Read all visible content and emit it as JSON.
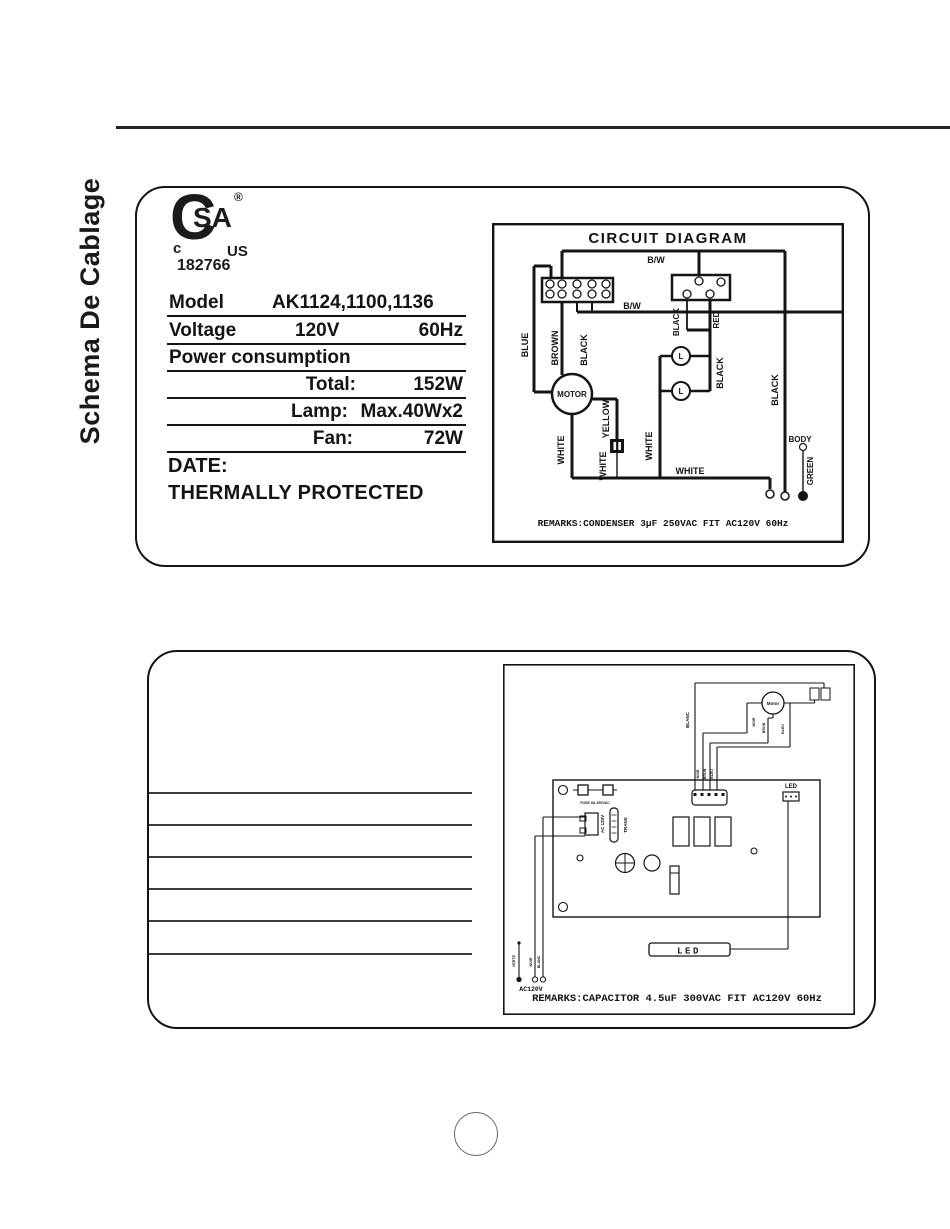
{
  "page": {
    "side_title": "Schema De Cablage"
  },
  "csa": {
    "mark_c": "C",
    "mark_sa": "SA",
    "reg": "®",
    "small_c": "c",
    "small_us": "US",
    "number": "182766"
  },
  "spec": {
    "rows": [
      {
        "c1": "Model",
        "c2": "AK1124,1100,1136",
        "c3": ""
      },
      {
        "c1": "Voltage",
        "c2": "120V",
        "c3": "60Hz"
      },
      {
        "c1": "Power consumption",
        "c2": "",
        "c3": ""
      },
      {
        "c1": "",
        "c2": "Total:",
        "c3": "152W"
      },
      {
        "c1": "",
        "c2": "Lamp:",
        "c3": "Max.40Wx2"
      },
      {
        "c1": "",
        "c2": "Fan:",
        "c3": "72W"
      }
    ],
    "date": "DATE:",
    "thermal": "THERMALLY PROTECTED"
  },
  "circuit1": {
    "title": "CIRCUIT DIAGRAM",
    "bw_top": "B/W",
    "bw_mid": "B/W",
    "blue": "BLUE",
    "brown": "BROWN",
    "black_left": "BLACK",
    "black_conn": "BLACK",
    "red": "RED",
    "black_lamp": "BLACK",
    "black_right": "BLACK",
    "white_motor": "WHITE",
    "white_cap": "WHITE",
    "white_lamp": "WHITE",
    "white_bottom": "WHITE",
    "yellow": "YELLOW",
    "motor": "MOTOR",
    "lamp1": "L",
    "lamp2": "L",
    "body": "BODY",
    "green": "GREEN",
    "remarks": "REMARKS:CONDENSER 3µF  250VAC FIT AC120V 60Hz"
  },
  "circuit2": {
    "motor": "Motor",
    "blanc": "BLANC",
    "noir_motor": "NOIR",
    "brun_motor": "BRUN",
    "bleu_motor": "BLEU",
    "noir_conn": "NOIR",
    "brun_conn": "BRUN",
    "bleu_conn": "BLEU",
    "fuse": "FUSE 8A 250VAC",
    "ac_pcb": "AC 120V",
    "trans": "TRANS",
    "led_conn": "LED",
    "led_box": "LED",
    "verte": "VERTE",
    "noir_in": "NOIR",
    "blanc_in": "BLANC",
    "ac_in": "AC120V",
    "remarks": "REMARKS:CAPACITOR 4.5uF  300VAC FIT AC120V 60Hz"
  }
}
